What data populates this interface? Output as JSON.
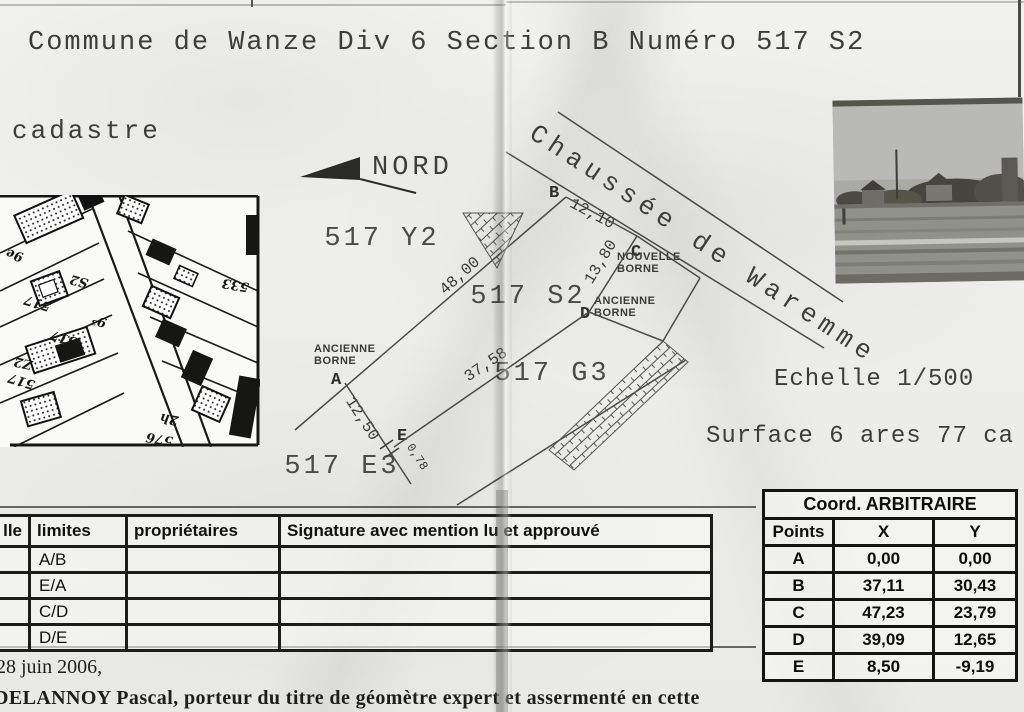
{
  "doc_title": "Commune de Wanze Div 6 Section B Numéro 517 S2",
  "cadastre_label": "cadastre",
  "map": {
    "labels": [
      {
        "text": "9e",
        "x": 6,
        "y": 52,
        "rot": 195
      },
      {
        "text": "S2",
        "x": 70,
        "y": 78,
        "rot": 195
      },
      {
        "text": "533",
        "x": 222,
        "y": 82,
        "rot": 190
      },
      {
        "text": "517",
        "x": 24,
        "y": 100,
        "rot": 197
      },
      {
        "text": "9³",
        "x": 92,
        "y": 118,
        "rot": 195
      },
      {
        "text": "517",
        "x": 50,
        "y": 135,
        "rot": 197
      },
      {
        "text": "Z2",
        "x": 14,
        "y": 160,
        "rot": 192
      },
      {
        "text": "517",
        "x": 8,
        "y": 178,
        "rot": 197
      },
      {
        "text": "2h",
        "x": 160,
        "y": 216,
        "rot": 190
      },
      {
        "text": "576",
        "x": 146,
        "y": 236,
        "rot": 190
      }
    ]
  },
  "sketch": {
    "north_label": "NORD",
    "street_label": "Chaussée de Waremme",
    "parcel_labels": [
      {
        "text": "517 Y2",
        "x": 382,
        "y": 239
      },
      {
        "text": "517 S2",
        "x": 528,
        "y": 297
      },
      {
        "text": "517 G3",
        "x": 552,
        "y": 374
      },
      {
        "text": "517 E3",
        "x": 342,
        "y": 467
      }
    ],
    "point_labels": [
      {
        "text": "A",
        "x": 331,
        "y": 371
      },
      {
        "text": "B",
        "x": 549,
        "y": 184
      },
      {
        "text": "C",
        "x": 631,
        "y": 243
      },
      {
        "text": "D",
        "x": 580,
        "y": 305
      },
      {
        "text": "E",
        "x": 397,
        "y": 427
      }
    ],
    "borne_labels": [
      {
        "line1": "NOUVELLE",
        "line2": "BORNE",
        "x": 617,
        "y": 252
      },
      {
        "line1": "ANCIENNE",
        "line2": "BORNE",
        "x": 594,
        "y": 296
      },
      {
        "line1": "ANCIENNE",
        "line2": "BORNE",
        "x": 314,
        "y": 344
      }
    ],
    "measurements": [
      {
        "text": "48,00",
        "x": 460,
        "y": 277,
        "rot": -42,
        "size": 16
      },
      {
        "text": "12,10",
        "x": 592,
        "y": 215,
        "rot": 28,
        "size": 16
      },
      {
        "text": "13,80",
        "x": 601,
        "y": 263,
        "rot": -59,
        "size": 16
      },
      {
        "text": "37,58",
        "x": 486,
        "y": 366,
        "rot": -34,
        "size": 16
      },
      {
        "text": "12,50",
        "x": 362,
        "y": 420,
        "rot": 57,
        "size": 16
      },
      {
        "text": "0,78",
        "x": 417,
        "y": 460,
        "rot": 57,
        "size": 12
      }
    ],
    "scale_label": "Echelle 1/500",
    "surface_label": "Surface 6 ares 77 ca"
  },
  "signature_table": {
    "headers": [
      "lle",
      "limites",
      "propriétaires",
      "Signature avec mention lu et approuvé"
    ],
    "rows": [
      {
        "limites": "A/B"
      },
      {
        "limites": "E/A"
      },
      {
        "limites": "C/D"
      },
      {
        "limites": "D/E"
      }
    ]
  },
  "coord_table": {
    "title": "Coord. ARBITRAIRE",
    "headers": [
      "Points",
      "X",
      "Y"
    ],
    "rows": [
      {
        "point": "A",
        "x": "0,00",
        "y": "0,00"
      },
      {
        "point": "B",
        "x": "37,11",
        "y": "30,43"
      },
      {
        "point": "C",
        "x": "47,23",
        "y": "23,79"
      },
      {
        "point": "D",
        "x": "39,09",
        "y": "12,65"
      },
      {
        "point": "E",
        "x": "8,50",
        "y": "-9,19"
      }
    ]
  },
  "footer": {
    "date_line": "28 juin 2006,",
    "surveyor_line": "DELANNOY Pascal, porteur du titre de géomètre expert et assermenté en cette"
  }
}
